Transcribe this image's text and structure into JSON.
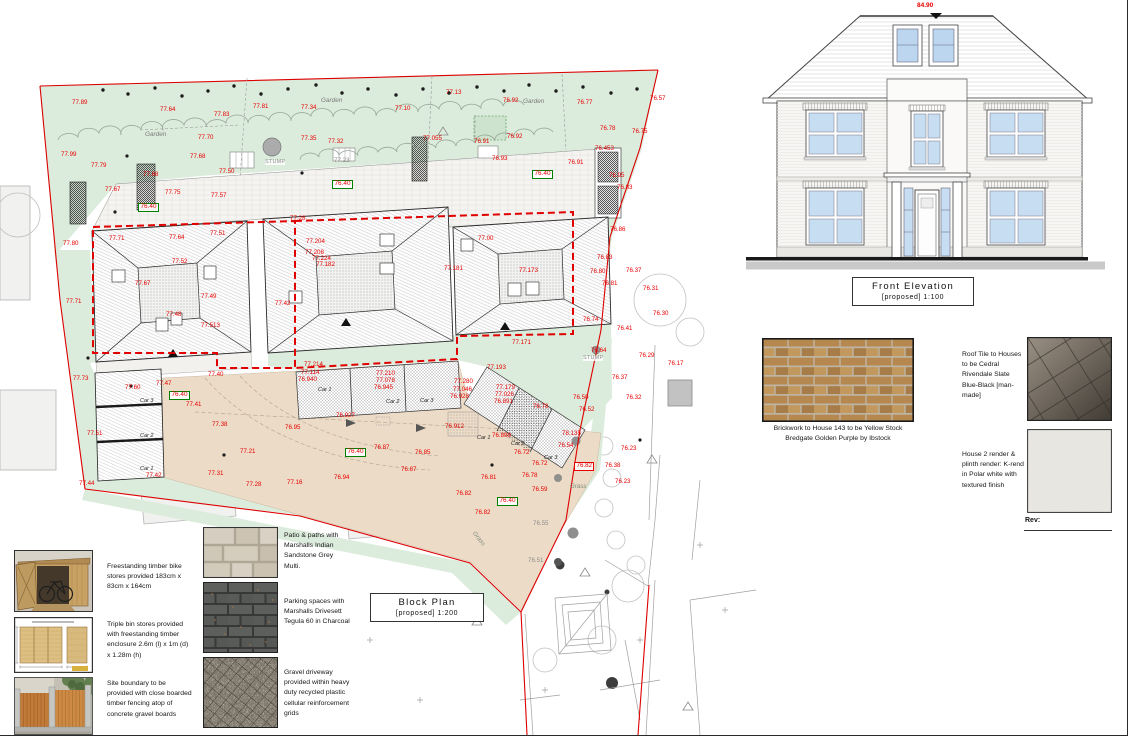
{
  "elevation": {
    "title": "Front Elevation",
    "subtitle": "[proposed]  1:100",
    "ridge_level": "84.90"
  },
  "plan_title": {
    "title": "Block Plan",
    "subtitle": "[proposed]  1:200"
  },
  "materials": {
    "brick_caption": "Brickwork to House 143 to be Yellow Stock Bredgate Golden Purple by Ibstock",
    "roof_tile_caption": "Roof Tile to Houses to be Cedral Rivendale Slate Blue-Black [man-made]",
    "render_caption": "House 2 render & plinth render: K-rend in Polar white with textured finish",
    "rev_label": "Rev:"
  },
  "legend": {
    "items": [
      {
        "id": "bike-store",
        "caption": "Freestanding timber bike stores provided 183cm x 83cm x 164cm"
      },
      {
        "id": "bin-store",
        "caption": "Triple bin stores provided with freestanding timber enclosure 2.6m (l) x 1m (d) x 1.28m (h)"
      },
      {
        "id": "fence",
        "caption": "Site boundary to be provided with close boarded timber fencing atop of concrete gravel boards"
      },
      {
        "id": "patio",
        "caption": "Patio & paths with Marshalls Indian Sandstone Grey Multi."
      },
      {
        "id": "parking",
        "caption": "Parking spaces with Marshalls Drivesett Tegula 60 in Charcoal"
      },
      {
        "id": "gravel",
        "caption": "Gravel driveway provided within heavy duty recycled plastic cellular reinforcement grids"
      }
    ]
  },
  "plan": {
    "labels": [
      {
        "t": "77.89",
        "x": 72,
        "y": 100,
        "k": "r"
      },
      {
        "t": "77.64",
        "x": 160,
        "y": 107,
        "k": "r"
      },
      {
        "t": "77.83",
        "x": 214,
        "y": 112,
        "k": "r"
      },
      {
        "t": "77.81",
        "x": 253,
        "y": 104,
        "k": "r"
      },
      {
        "t": "77.34",
        "x": 301,
        "y": 105,
        "k": "r"
      },
      {
        "t": "77.10",
        "x": 395,
        "y": 106,
        "k": "r"
      },
      {
        "t": "77.13",
        "x": 446,
        "y": 90,
        "k": "r"
      },
      {
        "t": "76.92",
        "x": 503,
        "y": 98,
        "k": "r"
      },
      {
        "t": "76.77",
        "x": 577,
        "y": 100,
        "k": "r"
      },
      {
        "t": "76.57",
        "x": 650,
        "y": 96,
        "k": "r"
      },
      {
        "t": "76.78",
        "x": 600,
        "y": 126,
        "k": "r"
      },
      {
        "t": "76.75",
        "x": 632,
        "y": 129,
        "k": "r"
      },
      {
        "t": "77.70",
        "x": 198,
        "y": 135,
        "k": "r"
      },
      {
        "t": "77.35",
        "x": 301,
        "y": 136,
        "k": "r"
      },
      {
        "t": "77.32",
        "x": 328,
        "y": 139,
        "k": "r"
      },
      {
        "t": "77.055",
        "x": 423,
        "y": 136,
        "k": "r"
      },
      {
        "t": "76.91",
        "x": 474,
        "y": 139,
        "k": "r"
      },
      {
        "t": "76.92",
        "x": 507,
        "y": 134,
        "k": "r"
      },
      {
        "t": "77.99",
        "x": 61,
        "y": 152,
        "k": "r"
      },
      {
        "t": "77.79",
        "x": 91,
        "y": 163,
        "k": "r"
      },
      {
        "t": "77.68",
        "x": 190,
        "y": 154,
        "k": "r"
      },
      {
        "t": "77.68",
        "x": 143,
        "y": 172,
        "k": "r"
      },
      {
        "t": "77.50",
        "x": 219,
        "y": 169,
        "k": "r"
      },
      {
        "t": "77.67",
        "x": 105,
        "y": 187,
        "k": "r"
      },
      {
        "t": "77.75",
        "x": 165,
        "y": 190,
        "k": "r"
      },
      {
        "t": "77.57",
        "x": 211,
        "y": 193,
        "k": "r"
      },
      {
        "t": "76.93",
        "x": 492,
        "y": 156,
        "k": "r"
      },
      {
        "t": "76.91",
        "x": 568,
        "y": 160,
        "k": "r"
      },
      {
        "t": "76.453",
        "x": 595,
        "y": 146,
        "k": "r"
      },
      {
        "t": "76.95",
        "x": 609,
        "y": 173,
        "k": "r"
      },
      {
        "t": "76.83",
        "x": 617,
        "y": 185,
        "k": "r"
      },
      {
        "t": "77.80",
        "x": 63,
        "y": 241,
        "k": "r"
      },
      {
        "t": "77.71",
        "x": 109,
        "y": 236,
        "k": "r"
      },
      {
        "t": "77.64",
        "x": 169,
        "y": 235,
        "k": "r"
      },
      {
        "t": "77.51",
        "x": 210,
        "y": 231,
        "k": "r"
      },
      {
        "t": "77.28",
        "x": 290,
        "y": 216,
        "k": "r"
      },
      {
        "t": "77.00",
        "x": 478,
        "y": 236,
        "k": "r"
      },
      {
        "t": "77.204",
        "x": 306,
        "y": 239,
        "k": "r"
      },
      {
        "t": "77.208",
        "x": 305,
        "y": 250,
        "k": "r"
      },
      {
        "t": "77.224",
        "x": 312,
        "y": 256,
        "k": "r"
      },
      {
        "t": "77.182",
        "x": 316,
        "y": 262,
        "k": "r"
      },
      {
        "t": "77.71",
        "x": 66,
        "y": 299,
        "k": "r"
      },
      {
        "t": "77.52",
        "x": 172,
        "y": 259,
        "k": "r"
      },
      {
        "t": "77.67",
        "x": 135,
        "y": 281,
        "k": "r"
      },
      {
        "t": "77.49",
        "x": 201,
        "y": 294,
        "k": "r"
      },
      {
        "t": "77.48",
        "x": 166,
        "y": 312,
        "k": "r"
      },
      {
        "t": "77.513",
        "x": 201,
        "y": 323,
        "k": "r"
      },
      {
        "t": "77.42",
        "x": 275,
        "y": 301,
        "k": "r"
      },
      {
        "t": "77.181",
        "x": 444,
        "y": 266,
        "k": "r"
      },
      {
        "t": "77.173",
        "x": 519,
        "y": 268,
        "k": "r"
      },
      {
        "t": "76.83",
        "x": 597,
        "y": 255,
        "k": "r"
      },
      {
        "t": "76.80",
        "x": 590,
        "y": 269,
        "k": "r"
      },
      {
        "t": "76.81",
        "x": 602,
        "y": 281,
        "k": "r"
      },
      {
        "t": "76.37",
        "x": 626,
        "y": 268,
        "k": "r"
      },
      {
        "t": "76.31",
        "x": 643,
        "y": 286,
        "k": "r"
      },
      {
        "t": "76.30",
        "x": 653,
        "y": 311,
        "k": "r"
      },
      {
        "t": "76.74",
        "x": 583,
        "y": 317,
        "k": "r"
      },
      {
        "t": "76.41",
        "x": 617,
        "y": 326,
        "k": "r"
      },
      {
        "t": "76.86",
        "x": 610,
        "y": 227,
        "k": "r"
      },
      {
        "t": "76.64",
        "x": 591,
        "y": 348,
        "k": "r"
      },
      {
        "t": "76.29",
        "x": 639,
        "y": 353,
        "k": "r"
      },
      {
        "t": "76.17",
        "x": 668,
        "y": 361,
        "k": "r"
      },
      {
        "t": "76.37",
        "x": 612,
        "y": 375,
        "k": "r"
      },
      {
        "t": "76.50",
        "x": 573,
        "y": 395,
        "k": "r"
      },
      {
        "t": "76.52",
        "x": 579,
        "y": 407,
        "k": "r"
      },
      {
        "t": "76.32",
        "x": 626,
        "y": 395,
        "k": "r"
      },
      {
        "t": "78.135",
        "x": 562,
        "y": 431,
        "k": "r"
      },
      {
        "t": "76.54",
        "x": 558,
        "y": 443,
        "k": "r"
      },
      {
        "t": "76.38",
        "x": 605,
        "y": 463,
        "k": "r"
      },
      {
        "t": "76.23",
        "x": 621,
        "y": 446,
        "k": "r"
      },
      {
        "t": "76.23",
        "x": 615,
        "y": 479,
        "k": "r"
      },
      {
        "t": "77.171",
        "x": 512,
        "y": 340,
        "k": "r"
      },
      {
        "t": "77.193",
        "x": 487,
        "y": 365,
        "k": "r"
      },
      {
        "t": "77.73",
        "x": 73,
        "y": 376,
        "k": "r"
      },
      {
        "t": "77.47",
        "x": 156,
        "y": 381,
        "k": "r"
      },
      {
        "t": "77.40",
        "x": 208,
        "y": 372,
        "k": "r"
      },
      {
        "t": "77.60",
        "x": 125,
        "y": 385,
        "k": "r"
      },
      {
        "t": "77.214",
        "x": 304,
        "y": 362,
        "k": "r"
      },
      {
        "t": "77.114",
        "x": 301,
        "y": 370,
        "k": "r"
      },
      {
        "t": "76.940",
        "x": 298,
        "y": 377,
        "k": "r"
      },
      {
        "t": "77.210",
        "x": 376,
        "y": 371,
        "k": "r"
      },
      {
        "t": "77.078",
        "x": 376,
        "y": 378,
        "k": "r"
      },
      {
        "t": "76.945",
        "x": 374,
        "y": 385,
        "k": "r"
      },
      {
        "t": "77.280",
        "x": 454,
        "y": 379,
        "k": "r"
      },
      {
        "t": "77.046",
        "x": 453,
        "y": 387,
        "k": "r"
      },
      {
        "t": "76.928",
        "x": 450,
        "y": 394,
        "k": "r"
      },
      {
        "t": "77.179",
        "x": 496,
        "y": 385,
        "k": "r"
      },
      {
        "t": "77.026",
        "x": 495,
        "y": 392,
        "k": "r"
      },
      {
        "t": "76.891",
        "x": 494,
        "y": 399,
        "k": "r"
      },
      {
        "t": "76.78",
        "x": 533,
        "y": 404,
        "k": "r"
      },
      {
        "t": "77.41",
        "x": 186,
        "y": 402,
        "k": "r"
      },
      {
        "t": "77.38",
        "x": 212,
        "y": 422,
        "k": "r"
      },
      {
        "t": "77.51",
        "x": 87,
        "y": 431,
        "k": "r"
      },
      {
        "t": "77.21",
        "x": 240,
        "y": 449,
        "k": "r"
      },
      {
        "t": "77.42",
        "x": 146,
        "y": 473,
        "k": "r"
      },
      {
        "t": "77.31",
        "x": 208,
        "y": 471,
        "k": "r"
      },
      {
        "t": "77.44",
        "x": 79,
        "y": 481,
        "k": "r"
      },
      {
        "t": "77.28",
        "x": 246,
        "y": 482,
        "k": "r"
      },
      {
        "t": "76.927",
        "x": 336,
        "y": 413,
        "k": "r"
      },
      {
        "t": "76.95",
        "x": 285,
        "y": 425,
        "k": "r"
      },
      {
        "t": "76.912",
        "x": 445,
        "y": 424,
        "k": "r"
      },
      {
        "t": "76.898",
        "x": 492,
        "y": 433,
        "k": "r"
      },
      {
        "t": "76.72",
        "x": 514,
        "y": 450,
        "k": "r"
      },
      {
        "t": "76.72",
        "x": 532,
        "y": 461,
        "k": "r"
      },
      {
        "t": "76.87",
        "x": 374,
        "y": 445,
        "k": "r"
      },
      {
        "t": "76.85",
        "x": 415,
        "y": 450,
        "k": "r"
      },
      {
        "t": "76.87",
        "x": 401,
        "y": 467,
        "k": "r"
      },
      {
        "t": "76.94",
        "x": 334,
        "y": 475,
        "k": "r"
      },
      {
        "t": "77.16",
        "x": 287,
        "y": 480,
        "k": "r"
      },
      {
        "t": "76.81",
        "x": 481,
        "y": 475,
        "k": "r"
      },
      {
        "t": "76.78",
        "x": 522,
        "y": 473,
        "k": "r"
      },
      {
        "t": "76.82",
        "x": 456,
        "y": 491,
        "k": "r"
      },
      {
        "t": "76.59",
        "x": 532,
        "y": 487,
        "k": "r"
      },
      {
        "t": "76.82",
        "x": 475,
        "y": 510,
        "k": "r"
      },
      {
        "t": "76.55",
        "x": 533,
        "y": 521,
        "k": "g"
      },
      {
        "t": "76.51",
        "x": 528,
        "y": 558,
        "k": "g"
      },
      {
        "t": "77.23",
        "x": 334,
        "y": 158,
        "k": "g"
      },
      {
        "t": "76.40",
        "x": 138,
        "y": 203,
        "k": "gb"
      },
      {
        "t": "76.40",
        "x": 332,
        "y": 180,
        "k": "gb"
      },
      {
        "t": "76.40",
        "x": 532,
        "y": 170,
        "k": "gb"
      },
      {
        "t": "76.40",
        "x": 169,
        "y": 391,
        "k": "gb"
      },
      {
        "t": "76.40",
        "x": 345,
        "y": 448,
        "k": "gb"
      },
      {
        "t": "76.40",
        "x": 497,
        "y": 497,
        "k": "gb"
      },
      {
        "t": "76.82",
        "x": 574,
        "y": 462,
        "k": "rb"
      },
      {
        "t": "Garden",
        "x": 145,
        "y": 132,
        "k": "garden"
      },
      {
        "t": "Garden",
        "x": 321,
        "y": 98,
        "k": "garden"
      },
      {
        "t": "Garden",
        "x": 523,
        "y": 99,
        "k": "garden"
      },
      {
        "t": "Grass",
        "x": 570,
        "y": 484,
        "k": "grass"
      },
      {
        "t": "Grass",
        "x": 470,
        "y": 536,
        "k": "grass",
        "rot": 52
      },
      {
        "t": "STUMP",
        "x": 265,
        "y": 160,
        "k": "stump"
      },
      {
        "t": "STUMP",
        "x": 583,
        "y": 356,
        "k": "stump"
      },
      {
        "t": "Car 3",
        "x": 140,
        "y": 399,
        "k": "car"
      },
      {
        "t": "Car 2",
        "x": 140,
        "y": 434,
        "k": "car"
      },
      {
        "t": "Car 1",
        "x": 140,
        "y": 467,
        "k": "car"
      },
      {
        "t": "Car 1",
        "x": 318,
        "y": 388,
        "k": "car"
      },
      {
        "t": "Car 2",
        "x": 386,
        "y": 400,
        "k": "car"
      },
      {
        "t": "Car 3",
        "x": 420,
        "y": 399,
        "k": "car"
      },
      {
        "t": "Car 1",
        "x": 477,
        "y": 436,
        "k": "car"
      },
      {
        "t": "Car 2",
        "x": 511,
        "y": 442,
        "k": "car"
      },
      {
        "t": "Car 3",
        "x": 544,
        "y": 456,
        "k": "car"
      }
    ]
  }
}
